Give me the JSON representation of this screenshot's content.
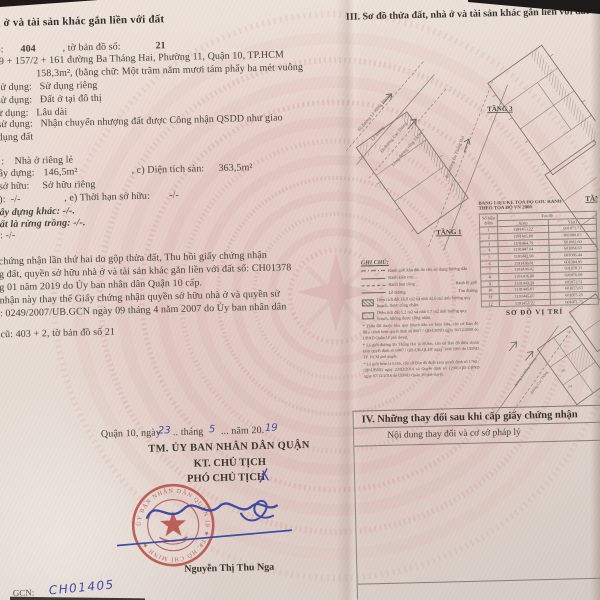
{
  "left_page": {
    "title": "à ở và tài sản khác gắn liền với đất",
    "row_plot": {
      "a": "ố:",
      "b": "404",
      "c": ", tờ bản đồ số:",
      "d": "21"
    },
    "lines1": [
      "59 + 157/2 + 161 đường Ba Tháng Hai, Phường 11, Quận 10, TP.HCM",
      "158,3m², (bằng chữ: Một trăm năm mươi tám phẩy ba mét vuông",
      "sử dụng:   Sử dụng riêng",
      "sử dụng:   Đất ở tại đô thị",
      "ử dụng:   Lâu dài",
      "sử dụng:   Nhận chuyển nhượng đất được Công nhận QSDD như giao",
      "dụng đất"
    ],
    "row_house_type": ":    Nhà ở riêng lẻ",
    "row_area": {
      "a": "ây dựng:",
      "b": "146,5m²",
      "c": ", c) Diện tích sàn:",
      "d": "363,5m²"
    },
    "row_own": "sở hữu:     Sở hữu riêng",
    "row_term": {
      "a": "):  -/-",
      "b": ", e) Thời hạn sở hữu:",
      "c": "-/-"
    },
    "row_other1": "ây dựng khác: -/-.",
    "row_other2": "ất là rừng trồng: -/-.",
    "row_other3": ": -/-",
    "notes": [
      "chứng nhận lần thứ hai do gộp thửa đất, Thu hồi giấy chứng nhận",
      "g đất, quyền sở hữu nhà ở và tài sản khác gắn liền với đất số: CH01378",
      "g 01 năm 2019 do Ủy ban nhân dân Quận 10 cấp.",
      "nhận này thay thế Giấy chứng nhận quyền sở hữu nhà ở và quyền sử",
      ": 0249/2007/UB.GCN ngày 09 tháng 4 năm 2007 do Ủy ban nhân dân"
    ],
    "row_old": "cũ: 403 + 2, tờ bản đồ số 21",
    "date_line": {
      "prefix": "Quận 10, ngày",
      "day": "23",
      "mid1": ".. tháng",
      "month": "5",
      "mid2": "... năm 20.",
      "year": "19"
    },
    "issuer": {
      "line1": "TM. ỦY BAN NHÂN DÂN QUẬN",
      "line2": "KT. CHỦ TỊCH",
      "line3": "PHÓ CHỦ TỊCH"
    },
    "signer_name": "Nguyễn Thị Thu Nga",
    "stamp_text": "ỦY BAN NHÂN DÂN QUẬN 10 ★ TP. HỒ CHÍ MINH ★",
    "gcn_label": "GCN:",
    "gcn_number_handwritten": "CH01405"
  },
  "right_page": {
    "title": "III. Sơ đồ thửa đất, nhà ở và tài sản khác gắn liền với đất",
    "diagram": {
      "street_labels": [
        "Đi đường Lê Hồng Phong",
        "Lề đường",
        "Đi đường Cao Thắng",
        "Lòng đường rộng 15,0m",
        "Ra đường Ba Tháng Hai"
      ],
      "floor_labels": [
        "TẦNG 1",
        "TẦNG 3",
        "TẦNG"
      ]
    },
    "legend": {
      "title": "GHI CHÚ:",
      "item1": "Ranh giới khu đất do chủ sử dụng hướng dẫn",
      "item2": "Ranh kiến trúc",
      "item3a": "Ranh ban công",
      "item3b": "Ranh lộ giới",
      "item4a": "Lề đường",
      "item4b": "Tim đường",
      "item5": "Diện tích đất 16,8 m2 và nhà 42,6 m2 ảnh hưởng quy hoạch, được công nhận.",
      "item6": "Diện tích đất 1,2 m2 và nhà 5,7 m2 ảnh hưởng quy hoạch, không được công nhận.",
      "note1": "* Thửa đất thuộc khu quy hoạch dân cư hiện hữu, căn cứ Bản đồ điều chỉnh kèm quyết định số 8007 / QĐ-UBND ngày 30/12/2008 do UBND Quận 10 phê duyệt.",
      "note2": "* Lộ giới đường Ba Tháng Hai là 30,0m, căn cứ Bản đồ điều chỉnh kèm quyết định số 6987 / QĐ-UB-QLĐT ngày 30/8/1995 do UBND TP. HCM phê duyệt.",
      "note3": "* Lộ giới hẻm là 6,0m, căn cứ Bản đồ đính kèm quyết định số 1762 / QĐ-UBND ngày 23/02/2014 và Quyết định số 12001/QĐ-UBND ngày 07/12/2016 do UBND Quận 10 phê duyệt."
    },
    "coordinate_table": {
      "title1": "BẢNG LIỆT KÊ TỌA ĐỘ GÓC RANH",
      "title2": "THEO TỌA ĐỘ VN 2000",
      "col_point1": "Số hiệu",
      "col_point2": "điểm",
      "col_coord": "Tọa độ",
      "col_x": "X(m)",
      "col_y": "Y(m)",
      "rows": [
        [
          "1",
          "1191453.22",
          "601071.71"
        ],
        [
          "2",
          "1191465.80",
          "601080.03"
        ],
        [
          "3",
          "1191464.79",
          "601082.60"
        ],
        [
          "4",
          "1191447.04",
          "601084.63"
        ],
        [
          "5",
          "1191442.98",
          "601086.44"
        ],
        [
          "6",
          "1191438.81",
          "601084.95"
        ],
        [
          "7",
          "1191436.42",
          "601078.31"
        ],
        [
          "8",
          "1191436.80",
          "601076.09"
        ],
        [
          "9",
          "1191443.29",
          "601072.51"
        ],
        [
          "10",
          "1191445.07",
          "601073.63"
        ],
        [
          "11",
          "1191445.07",
          "601075.25"
        ],
        [
          "12",
          "1191453.22",
          "601071.71"
        ]
      ]
    },
    "location_map": {
      "title": "SƠ ĐỒ VỊ TRÍ",
      "street1": "đường Lê Hồng Phong",
      "street2": "đường Cao Thắng",
      "parcel1": "26",
      "parcel2": "24"
    },
    "section_iv": {
      "title": "IV. Những thay đổi sau khi cấp giấy chứng nhận",
      "col_header": "Nội dung thay đổi và cơ sở pháp lý"
    }
  }
}
